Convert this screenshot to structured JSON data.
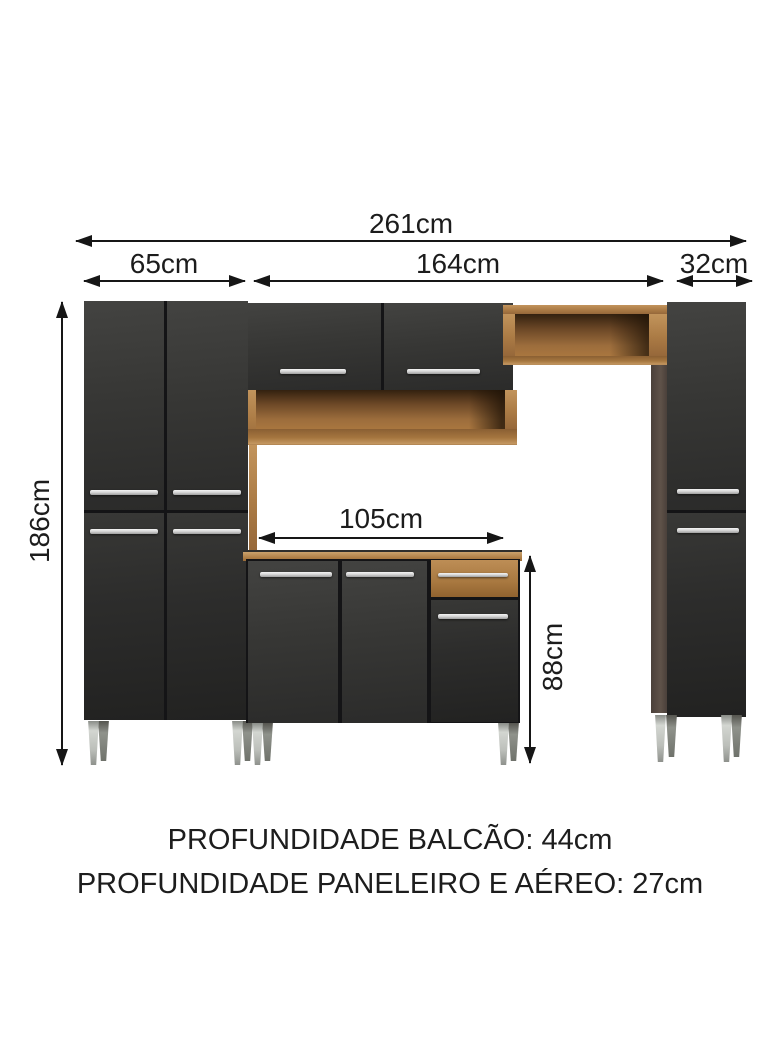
{
  "diagram": {
    "type": "kitchen-cabinet-dimension-diagram",
    "measurements": {
      "total_width": "261cm",
      "left_cabinet_width": "65cm",
      "middle_section_width": "164cm",
      "right_cabinet_width": "32cm",
      "total_height": "186cm",
      "counter_width": "105cm",
      "counter_height": "88cm"
    },
    "footer": {
      "line1": "PROFUNDIDADE BALCÃO: 44cm",
      "line2": "PROFUNDIDADE PANELEIRO E AÉREO: 27cm"
    },
    "colors": {
      "background": "#ffffff",
      "annotation": "#161616",
      "cabinet_dark": "#343433",
      "wood": "#ab7b45",
      "wood_dark": "#6b4726",
      "side_column": "#574b43",
      "handle_silver": "#d8d8d8",
      "leg_silver": "#c0c3be"
    }
  }
}
